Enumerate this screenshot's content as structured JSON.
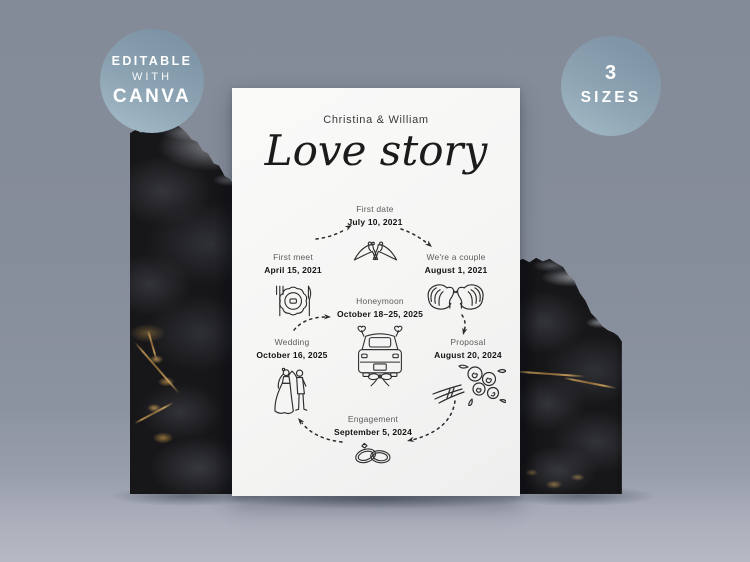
{
  "badges": {
    "editable": {
      "line1": "EDITABLE",
      "line2": "WITH",
      "line3": "CANVA"
    },
    "sizes": {
      "line1": "3",
      "line2": "SIZES"
    }
  },
  "card": {
    "names": "Christina & William",
    "title": "Love story",
    "timeline": {
      "first_meet": {
        "label": "First meet",
        "date": "April 15, 2021",
        "icon": "dinner-plate-icon"
      },
      "first_date": {
        "label": "First date",
        "date": "July 10, 2021",
        "icon": "high-heels-icon"
      },
      "couple": {
        "label": "We're a couple",
        "date": "August 1, 2021",
        "icon": "swans-icon"
      },
      "proposal": {
        "label": "Proposal",
        "date": "August 20, 2024",
        "icon": "bouquet-icon"
      },
      "engagement": {
        "label": "Engagement",
        "date": "September 5, 2024",
        "icon": "wedding-rings-icon"
      },
      "wedding": {
        "label": "Wedding",
        "date": "October 16, 2025",
        "icon": "bride-groom-icon"
      },
      "honeymoon": {
        "label": "Honeymoon",
        "date": "October 18–25, 2025",
        "icon": "wedding-car-icon"
      }
    }
  },
  "colors": {
    "background": "#868d9a",
    "floor": "#b6b9c4",
    "badge_blue": "#87a0b1",
    "card_white": "#f6f6f5",
    "ink": "#2d2d2d",
    "gold_vein": "#b08a50"
  }
}
